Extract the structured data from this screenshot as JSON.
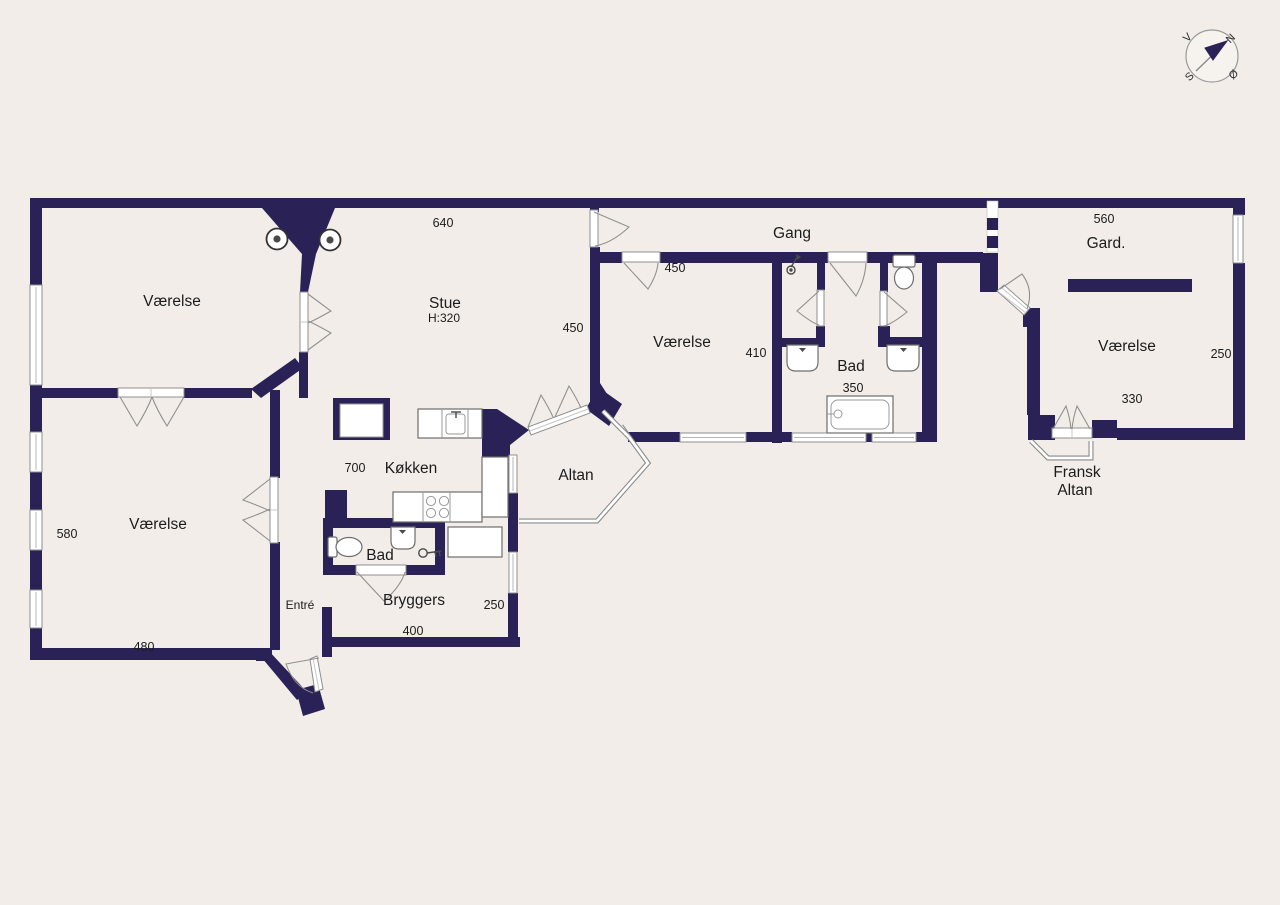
{
  "palette": {
    "background": "#f2ede8",
    "wall": "#2a2157",
    "line": "#8f8f8f",
    "text": "#1c1c1c"
  },
  "compass": {
    "west": "V",
    "north": "N",
    "south": "S",
    "east": "Ø"
  },
  "labels": {
    "vaerelse_nw": "Værelse",
    "stue": "Stue",
    "stue_height": "H:320",
    "gang": "Gang",
    "vaerelse_mid": "Værelse",
    "bad_mid": "Bad",
    "gard": "Gard.",
    "vaerelse_e": "Værelse",
    "fransk_line1": "Fransk",
    "fransk_line2": "Altan",
    "altan": "Altan",
    "koekken": "Køkken",
    "bad_sw": "Bad",
    "entre": "Entré",
    "bryggers": "Bryggers",
    "vaerelse_sw": "Værelse"
  },
  "dimensions": {
    "stue_width": "640",
    "vaerelse_mid_width": "450",
    "stue_depth": "450",
    "vaerelse_mid_depth": "410",
    "bad_mid_width": "350",
    "gard_width": "560",
    "vaerelse_e_depth": "250",
    "vaerelse_e_width": "330",
    "koekken_width": "700",
    "bryggers_depth": "250",
    "bryggers_width": "400",
    "vaerelse_sw_depth": "580",
    "vaerelse_sw_width": "480"
  }
}
